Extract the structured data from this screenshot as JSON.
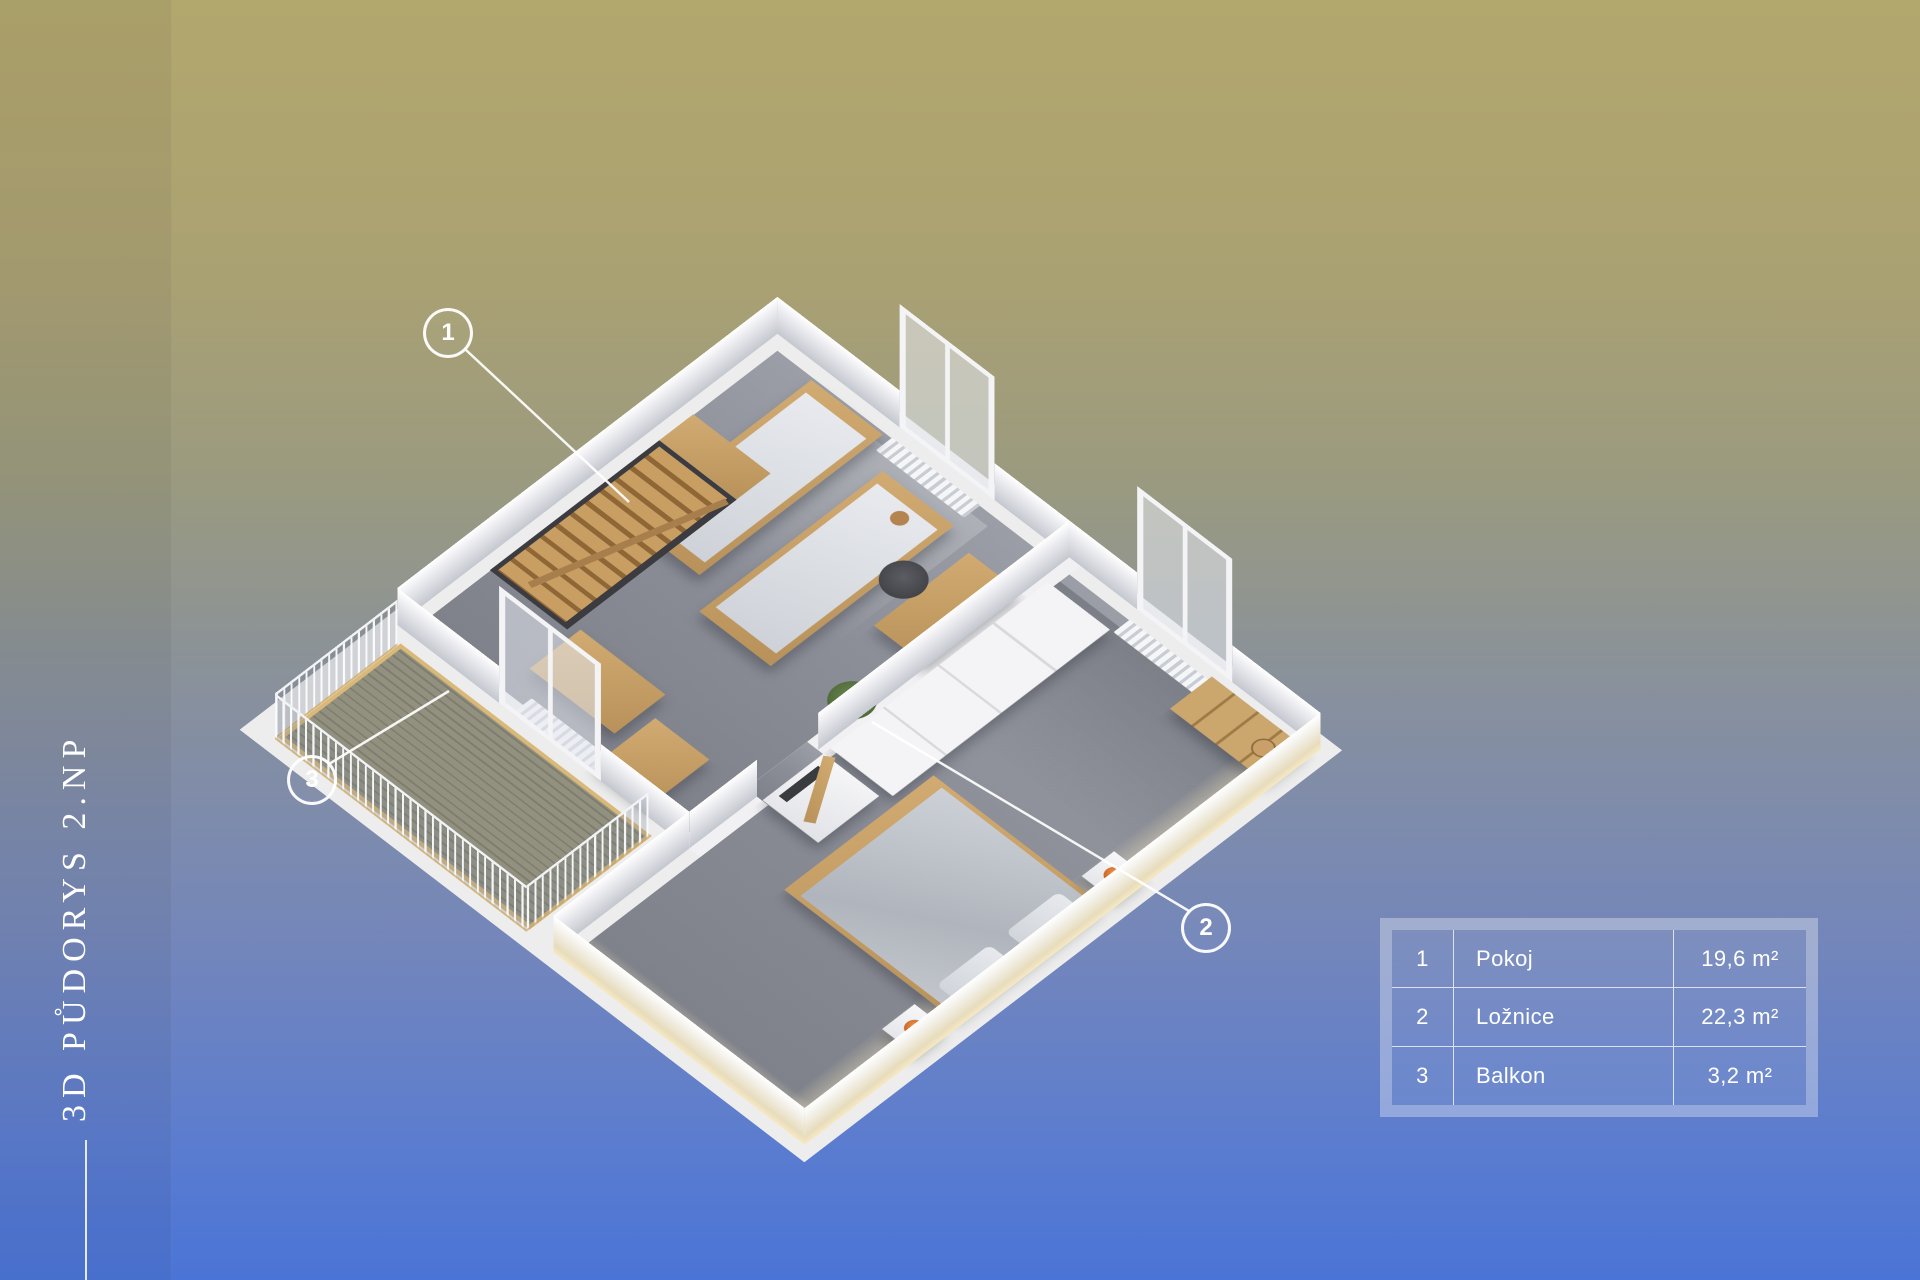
{
  "page": {
    "vertical_title": "3D PŮDORYS 2.NP"
  },
  "callouts": [
    {
      "num": "1"
    },
    {
      "num": "2"
    },
    {
      "num": "3"
    }
  ],
  "legend": {
    "rows": [
      {
        "num": "1",
        "label": "Pokoj",
        "area": "19,6 m²"
      },
      {
        "num": "2",
        "label": "Ložnice",
        "area": "22,3 m²"
      },
      {
        "num": "3",
        "label": "Balkon",
        "area": "3,2 m²"
      }
    ]
  },
  "colors": {
    "background_top": "#b2a76d",
    "background_bottom": "#4a74d6",
    "text": "#ffffff",
    "lamp_accent": "#d9732e",
    "wood": "#c29a62",
    "floor_gray": "#8b8e97"
  }
}
